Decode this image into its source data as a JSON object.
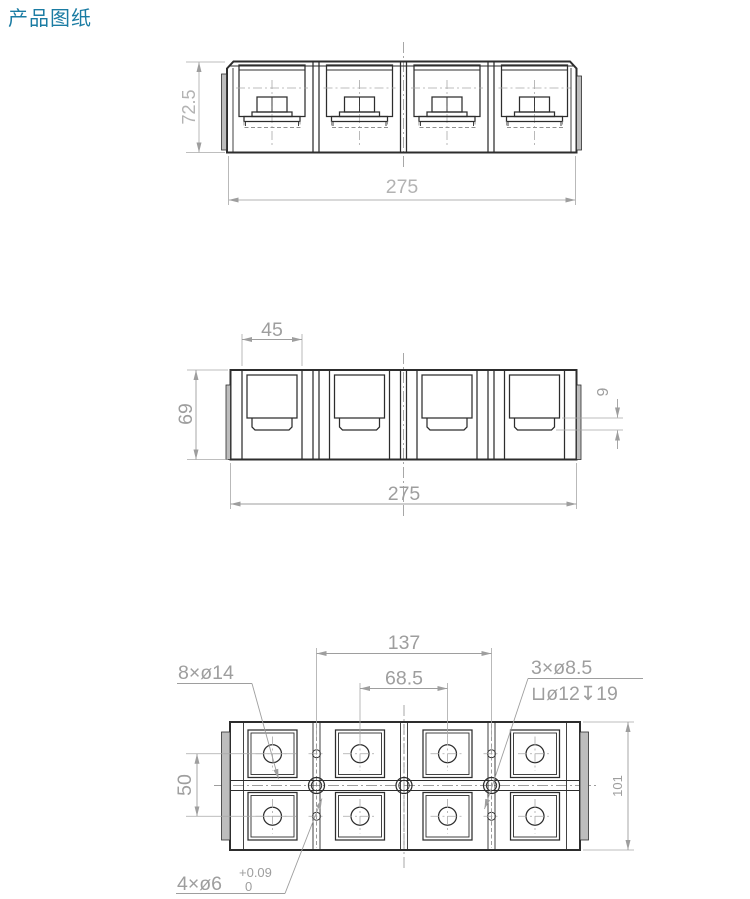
{
  "title": {
    "text": "产品图纸",
    "color": "#1b7ca3"
  },
  "drawing": {
    "front_view": {
      "dim_height": "72.5",
      "dim_width": "275"
    },
    "middle_view": {
      "dim_pocket_width": "45",
      "dim_height": "69",
      "dim_step": "9",
      "dim_width": "275"
    },
    "plan_view": {
      "dim_mount_span": "137",
      "dim_inner_span": "68.5",
      "dim_row_spacing": "50",
      "dim_depth": "101",
      "callout_large_holes": "8×ø14",
      "callout_cbore_count": "3×ø8.5",
      "callout_cbore_spec": "⊔ø12↧19",
      "callout_small_holes": "4×ø6",
      "small_hole_tol_upper": "+0.09",
      "small_hole_tol_lower": "0"
    },
    "colors": {
      "outline": "#2d2d2d",
      "dimension": "#9e9e9e",
      "dimension_light": "#b3b3b3",
      "tab_fill": "#bdbdbd",
      "background": "#ffffff"
    }
  }
}
